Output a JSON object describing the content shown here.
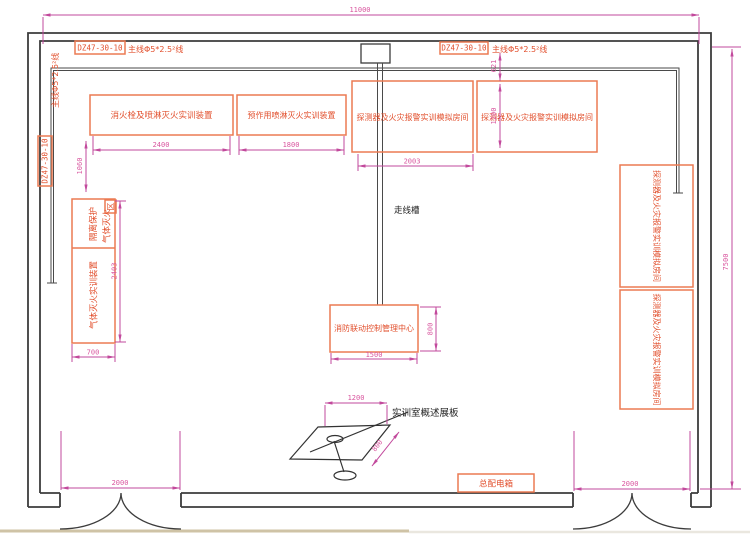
{
  "labels": {
    "breaker": "DZ47-30-10",
    "mainline": "主线Φ5*2.5²线",
    "hydrant": "消火栓及喷淋灭火实训装置",
    "preaction": "预作用喷淋灭火实训装置",
    "detector_room": "探测器及火灾报警实训模拟房间",
    "gas_zone_col1": "气体灭火",
    "gas_zone_col2": "隔离保护",
    "gas_zone_col3": "区",
    "gas_device": "气体灭火实训装置",
    "control_center": "消防联动控制管理中心",
    "cable_tray": "走线槽",
    "board": "实训室概述展板",
    "power_box": "总配电箱"
  },
  "dims": {
    "overall_width": "11000",
    "overall_height": "7500",
    "hydrant_width": "2400",
    "preaction_width": "1800",
    "detector_width": "2003",
    "detector_height": "1200",
    "wire_offset": "621",
    "gas_offset": "1060",
    "gas_height": "2403",
    "gas_width": "700",
    "control_height": "800",
    "control_width": "1500",
    "board_width": "1200",
    "board_depth": "800",
    "door_left": "2000",
    "door_right": "2000"
  },
  "colors": {
    "wall": "#3c3c3c",
    "equipment_stroke": "#ec7a52",
    "equipment_text": "#e2502e",
    "dimension_line": "#c2499c",
    "dimension_text": "#d9569f",
    "ground_left": "#cfc3a6",
    "ground_right": "#eae7df"
  }
}
